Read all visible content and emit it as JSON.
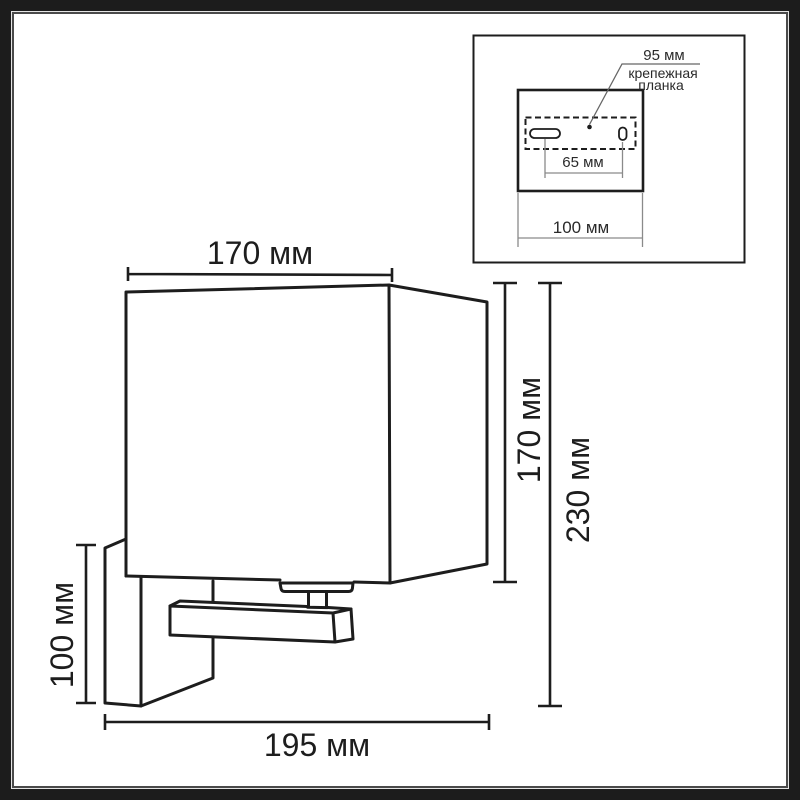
{
  "diagram": {
    "kind": "wall-sconce dimensional technical drawing",
    "dimensions": {
      "shade_width": "170 мм",
      "shade_height": "170 мм",
      "total_height": "230 мм",
      "backplate_height": "100 мм",
      "total_depth": "195 мм"
    },
    "inset": {
      "bracket_width": "95 мм",
      "bracket_name_line1": "крепежная",
      "bracket_name_line2": "планка",
      "hole_spacing": "65 мм",
      "plate_width": "100 мм"
    },
    "colors": {
      "line": "#1d1d1d",
      "inset_dim_gray": "#8a8a8a",
      "leader": "#666666",
      "background": "#ffffff",
      "frame": "#1c1c1c"
    }
  }
}
